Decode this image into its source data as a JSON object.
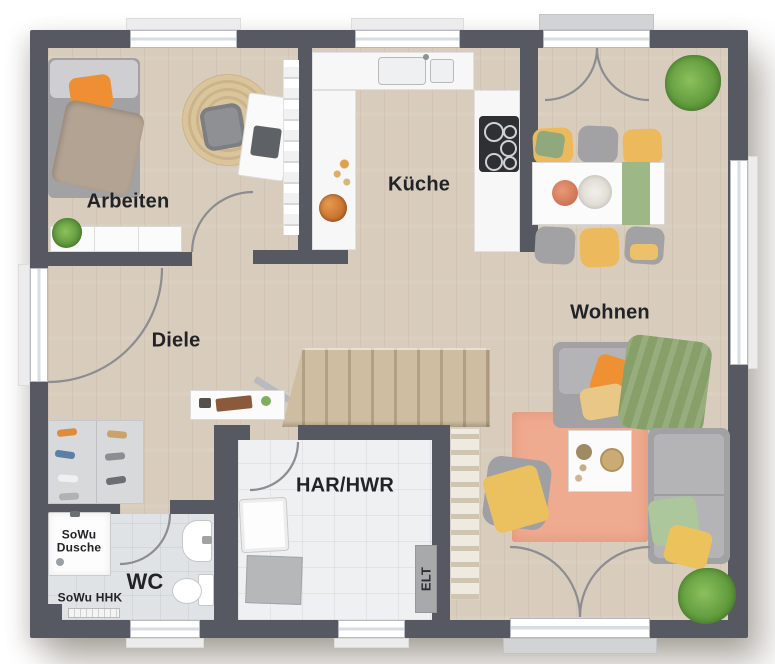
{
  "rooms": {
    "arbeiten": "Arbeiten",
    "kueche": "Küche",
    "wohnen": "Wohnen",
    "diele": "Diele",
    "har_hwr": "HAR/HWR",
    "wc": "WC"
  },
  "labels": {
    "shower_line1": "SoWu",
    "shower_line2": "Dusche",
    "heater": "SoWu HHK",
    "electrical": "ELT"
  },
  "colors": {
    "wall": "#565962",
    "floor_wood": "#d8ccbd",
    "tile_har": "#eef0f1",
    "tile_wc": "#e0e3e6",
    "stair_wood": "#cdbb9f",
    "accent_orange": "#ef9133",
    "accent_yellow": "#ecc25d",
    "accent_green": "#87a069",
    "sofa_gray": "#a2a2a4",
    "rug_salmon": "#efab90",
    "counter_white": "#f7f7f8",
    "jute_rug": "#d9c49c"
  }
}
